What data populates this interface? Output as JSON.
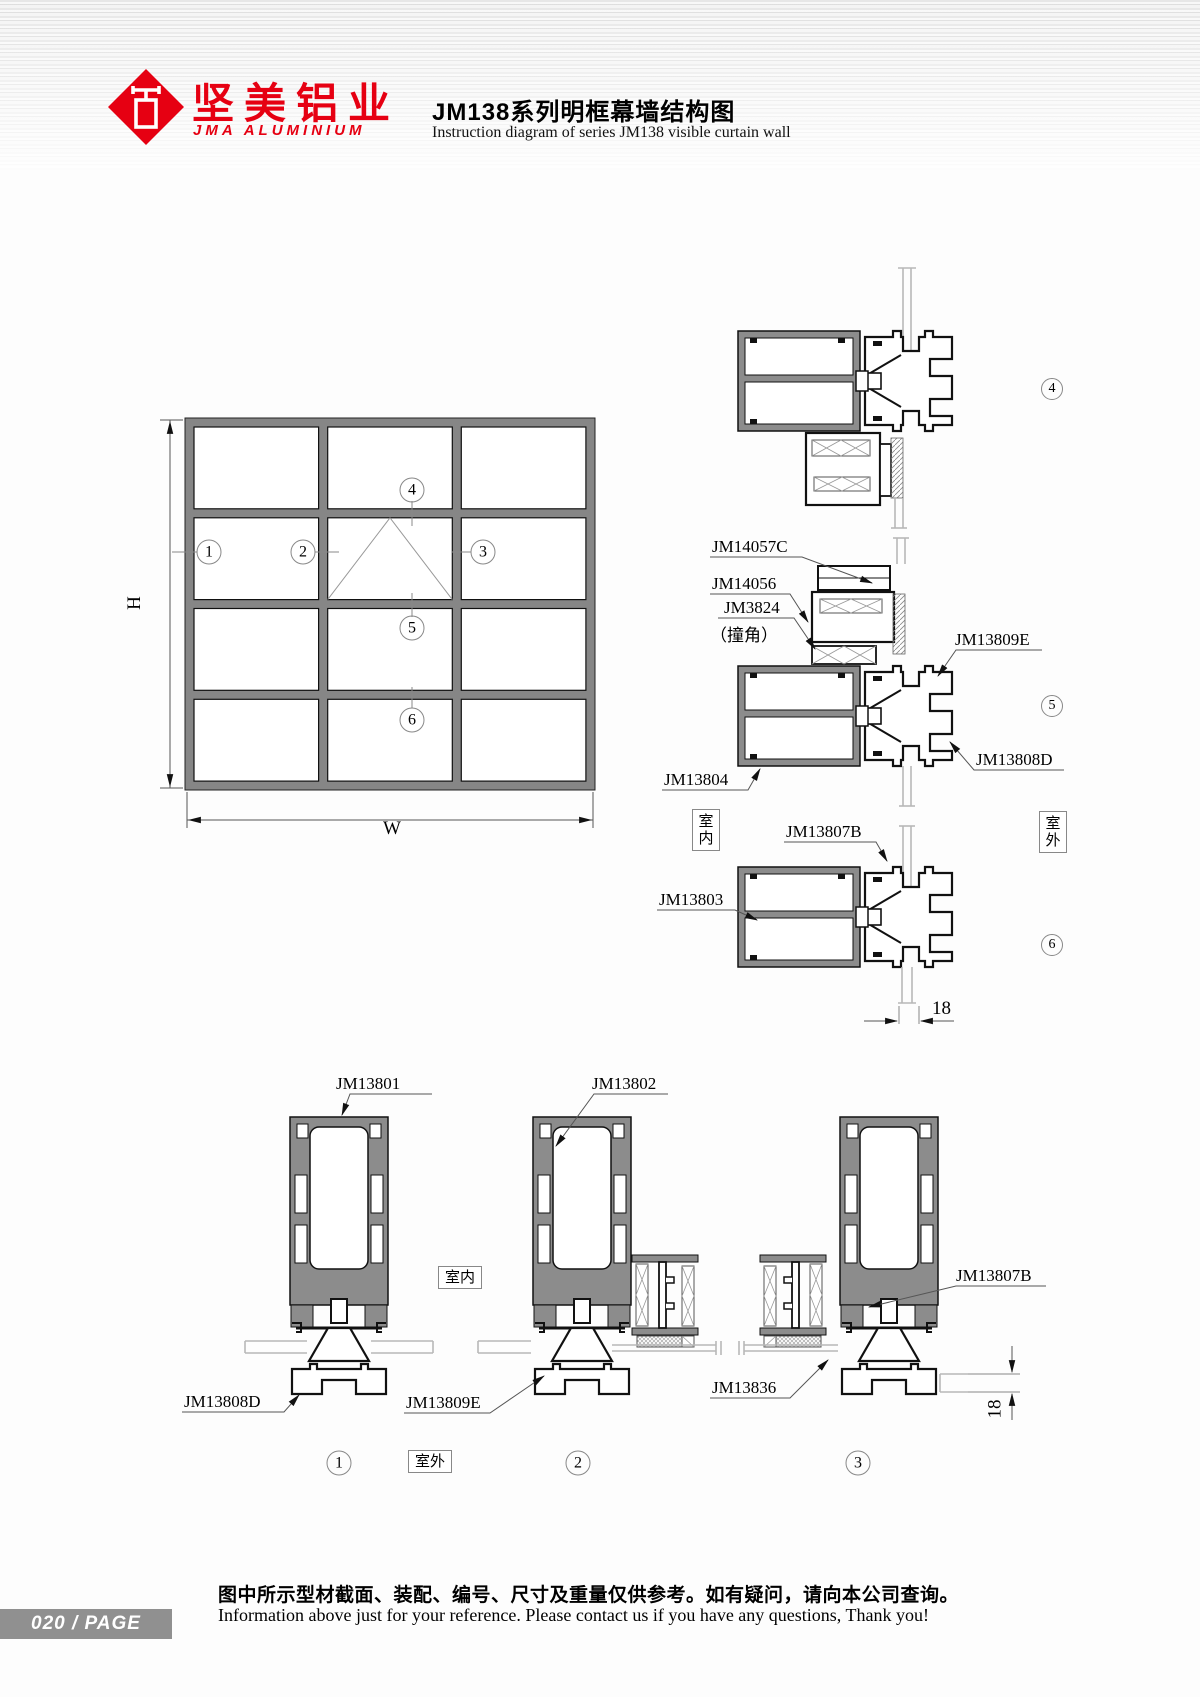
{
  "header": {
    "brand_cn": "坚美铝业",
    "brand_en": "JMA ALUMINIUM",
    "title_cn": "JM138系列明框幕墙结构图",
    "title_en": "Instruction diagram of series JM138 visible curtain wall",
    "brand_color": "#e60012"
  },
  "dims": {
    "h": "H",
    "w": "W",
    "d18": "18"
  },
  "markers": {
    "m1": "1",
    "m2": "2",
    "m3": "3",
    "m4": "4",
    "m5": "5",
    "m6": "6"
  },
  "rooms": {
    "indoor": "室内",
    "outdoor": "室外"
  },
  "parts": {
    "jm14057c": "JM14057C",
    "jm14056": "JM14056",
    "jm3824": "JM3824",
    "jm3824_note": "（撞角）",
    "jm13809e": "JM13809E",
    "jm13808d": "JM13808D",
    "jm13804": "JM13804",
    "jm13807b": "JM13807B",
    "jm13803": "JM13803",
    "jm13801": "JM13801",
    "jm13802": "JM13802",
    "jm13836": "JM13836"
  },
  "footer": {
    "page_text": "020 / PAGE",
    "note_cn": "图中所示型材截面、装配、编号、尺寸及重量仅供参考。如有疑问，请向本公司查询。",
    "note_en": "Information above just for your reference. Please contact us if you have any questions, Thank you!"
  }
}
